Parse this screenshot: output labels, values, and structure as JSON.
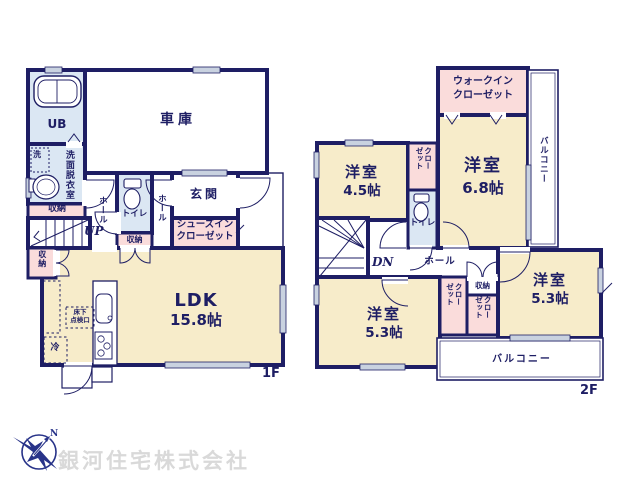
{
  "floor1": {
    "floor_label": "1F",
    "garage": "車庫",
    "unit_bath": "UB",
    "washroom": "洗面脱衣室",
    "washing_machine": "洗",
    "storage": "収納",
    "hall": "ホール",
    "stairs_up": "UP",
    "toilet": "トイレ",
    "entrance": "玄関",
    "shoe_closet_line1": "シューズイン",
    "shoe_closet_line2": "クローゼット",
    "ldk_name": "LDK",
    "ldk_size": "15.8帖",
    "underfloor_hatch_line1": "床下",
    "underfloor_hatch_line2": "点検口",
    "fridge": "冷"
  },
  "floor2": {
    "floor_label": "2F",
    "wic_line1": "ウォークイン",
    "wic_line2": "クローゼット",
    "bedroom": "洋室",
    "bedroom_68_size": "6.8帖",
    "bedroom_45_size": "4.5帖",
    "bedroom_53_size": "5.3帖",
    "closet_col1": "クロー",
    "closet_col2": "ゼット",
    "toilet": "トイレ",
    "hall": "ホール",
    "stairs_down": "DN",
    "storage": "収納",
    "balcony": "バルコニー"
  },
  "compass": {
    "north": "N"
  },
  "company": {
    "name": "銀河住宅株式会社"
  },
  "colors": {
    "wall": "#1e1e64",
    "room_fill": "#f7ecca",
    "closet_fill": "#fadcdb",
    "wet_area_fill": "#dbe7f3",
    "window_fill": "#c9d2e0",
    "label_text": "#1e1e64",
    "logo_navy": "#283389",
    "company_text": "#d9d9d9"
  }
}
